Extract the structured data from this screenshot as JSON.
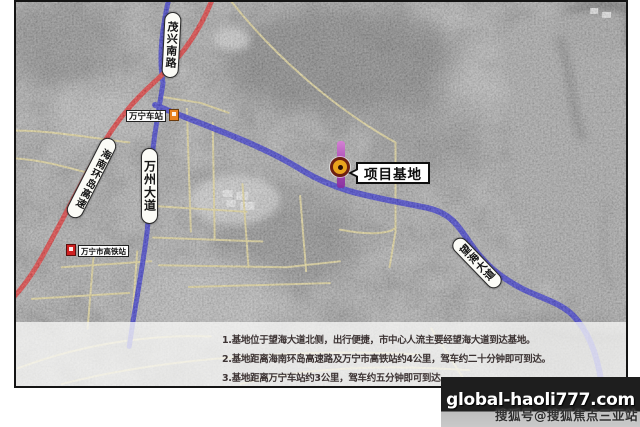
{
  "colors": {
    "road-yellow": "#e9d98c",
    "road-red": "#e01414",
    "road-blue": "#1a18c8",
    "marker-ring": "#6d2012",
    "marker-fill": "#e9a41e",
    "pin-purple": "#a843b4",
    "band-dark": "#1e1e1e"
  },
  "map": {
    "road_labels": {
      "maoxing_south_road": "茂兴南路",
      "hainan_ring_expressway": "海南环岛高速",
      "wanzhou_avenue": "万州大道",
      "wanghai_avenue": "望海大道"
    },
    "stations": {
      "wanning_station": "万宁车站",
      "wanning_hsr_station": "万宁市高铁站"
    },
    "project_base_label": "项目基地"
  },
  "notes": {
    "lines": [
      "1.基地位于望海大道北侧，出行便捷，市中心人流主要经望海大道到达基地。",
      "2.基地距离海南环岛高速路及万宁市高铁站约4公里，驾车约二十分钟即可到达。",
      "3.基地距离万宁车站约3公里，驾车约五分钟即可到达。"
    ]
  },
  "watermark": {
    "site": "global-haoli777.com",
    "account": "搜狐号@搜狐焦点三亚站"
  }
}
